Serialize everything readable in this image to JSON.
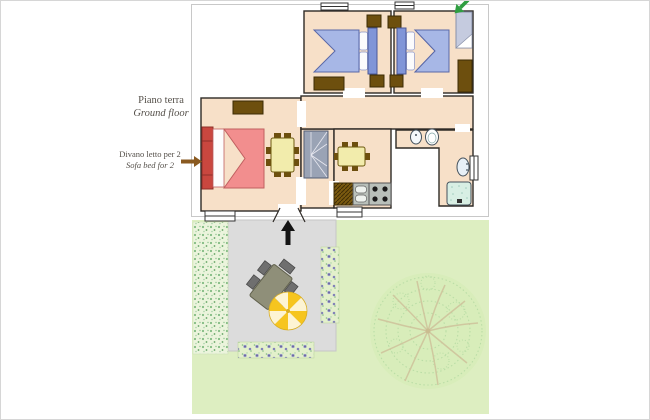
{
  "annotations": {
    "floor": {
      "it": "Piano terra",
      "en": "Ground floor"
    },
    "sofa_bed": {
      "it": "Divano letto per 2",
      "en": "Sofa bed for 2"
    }
  },
  "palette": {
    "floor_peach": "#f7e0c8",
    "wall": "#2e2a26",
    "bed_blue": "#a7b7e6",
    "headboard_blue": "#8095d8",
    "sofa_frame_red": "#c9473f",
    "sofa_bed_pink": "#f28e8e",
    "furniture_brown": "#6d4f0e",
    "table_cream": "#f2ecac",
    "stairs_gray": "#9aa3b5",
    "counter_gray": "#b9c0ba",
    "shower_teal": "#d8efe4",
    "closet_gray_blue": "#c5cbdf",
    "lawn_green": "#ddeec1",
    "patio_gray": "#dcdcdc",
    "umbrella_yellow": "#f6c51f",
    "umbrella_cream": "#fdf4d3",
    "north_arrow_green": "#2f9e41",
    "label_arrow_brown": "#8a5a20",
    "tree_branch_tan": "#cfc29b"
  },
  "plan": {
    "rooms": [
      "living-room",
      "hallway",
      "bedroom-1",
      "bedroom-2",
      "kitchen",
      "bathroom",
      "stair-vestibule"
    ],
    "furniture": [
      "sofa-bed",
      "dining-table",
      "kitchen-table",
      "staircase",
      "kitchen-counter",
      "sink",
      "stove",
      "bidet",
      "toilet",
      "washbasin",
      "shower",
      "double-bed-1",
      "double-bed-2",
      "wardrobe",
      "nightstand",
      "dresser",
      "closet"
    ]
  },
  "garden": {
    "elements": [
      "lawn",
      "patio",
      "hedge",
      "flower-bed-right",
      "flower-bed-bottom",
      "tree",
      "garden-table",
      "garden-chairs",
      "parasol",
      "entrance-arrow"
    ]
  }
}
